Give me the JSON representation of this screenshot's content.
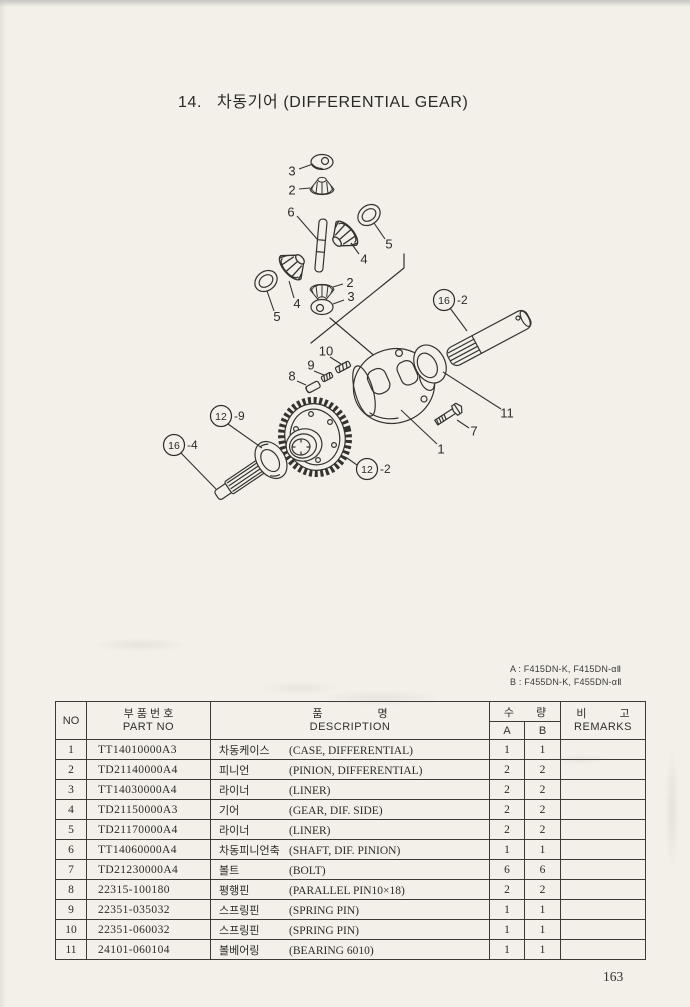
{
  "page": {
    "section_no": "14.",
    "title": "차동기어 (DIFFERENTIAL GEAR)",
    "page_number": "163",
    "model_note": {
      "line_a": "A : F415DN-K, F415DN-αⅡ",
      "line_b": "B : F455DN-K, F455DN-αⅡ"
    }
  },
  "colors": {
    "paper": "#f2f0e8",
    "ink": "#2f2e2a",
    "table_line": "#3b3a36"
  },
  "diagram": {
    "callouts": [
      {
        "label": "3"
      },
      {
        "label": "2"
      },
      {
        "label": "6"
      },
      {
        "label": "5"
      },
      {
        "label": "4"
      },
      {
        "label": "4"
      },
      {
        "label": "5"
      },
      {
        "label": "2"
      },
      {
        "label": "3"
      },
      {
        "label": "10"
      },
      {
        "label": "9"
      },
      {
        "label": "8"
      },
      {
        "num": "12",
        "suffix": "-9"
      },
      {
        "num": "16",
        "suffix": "-4"
      },
      {
        "num": "16",
        "suffix": "-2"
      },
      {
        "num": "12",
        "suffix": "-2"
      },
      {
        "label": "11"
      },
      {
        "label": "7"
      },
      {
        "label": "1"
      }
    ]
  },
  "table": {
    "headers": {
      "no": "NO",
      "part_kr": "부 품 번 호",
      "part_en": "PART NO",
      "desc_kr": "품　　　　　명",
      "desc_en": "DESCRIPTION",
      "qty_kr": "수　　량",
      "qty_a": "A",
      "qty_b": "B",
      "remarks_kr": "비　　　고",
      "remarks_en": "REMARKS"
    },
    "rows": [
      {
        "no": "1",
        "part_no": "TT14010000A3",
        "name_kr": "차동케이스",
        "desc_en": "(CASE, DIFFERENTIAL)",
        "qty_a": "1",
        "qty_b": "1",
        "remarks": ""
      },
      {
        "no": "2",
        "part_no": "TD21140000A4",
        "name_kr": "피니언",
        "desc_en": "(PINION, DIFFERENTIAL)",
        "qty_a": "2",
        "qty_b": "2",
        "remarks": ""
      },
      {
        "no": "3",
        "part_no": "TT14030000A4",
        "name_kr": "라이너",
        "desc_en": "(LINER)",
        "qty_a": "2",
        "qty_b": "2",
        "remarks": ""
      },
      {
        "no": "4",
        "part_no": "TD21150000A3",
        "name_kr": "기어",
        "desc_en": "(GEAR, DIF. SIDE)",
        "qty_a": "2",
        "qty_b": "2",
        "remarks": ""
      },
      {
        "no": "5",
        "part_no": "TD21170000A4",
        "name_kr": "라이너",
        "desc_en": "(LINER)",
        "qty_a": "2",
        "qty_b": "2",
        "remarks": ""
      },
      {
        "no": "6",
        "part_no": "TT14060000A4",
        "name_kr": "차동피니언축",
        "desc_en": "(SHAFT, DIF. PINION)",
        "qty_a": "1",
        "qty_b": "1",
        "remarks": ""
      },
      {
        "no": "7",
        "part_no": "TD21230000A4",
        "name_kr": "볼트",
        "desc_en": "(BOLT)",
        "qty_a": "6",
        "qty_b": "6",
        "remarks": ""
      },
      {
        "no": "8",
        "part_no": "22315-100180",
        "name_kr": "평행핀",
        "desc_en": "(PARALLEL PIN10×18)",
        "qty_a": "2",
        "qty_b": "2",
        "remarks": ""
      },
      {
        "no": "9",
        "part_no": "22351-035032",
        "name_kr": "스프링핀",
        "desc_en": "(SPRING PIN)",
        "qty_a": "1",
        "qty_b": "1",
        "remarks": ""
      },
      {
        "no": "10",
        "part_no": "22351-060032",
        "name_kr": "스프링핀",
        "desc_en": "(SPRING PIN)",
        "qty_a": "1",
        "qty_b": "1",
        "remarks": ""
      },
      {
        "no": "11",
        "part_no": "24101-060104",
        "name_kr": "볼베어링",
        "desc_en": "(BEARING 6010)",
        "qty_a": "1",
        "qty_b": "1",
        "remarks": ""
      }
    ]
  }
}
